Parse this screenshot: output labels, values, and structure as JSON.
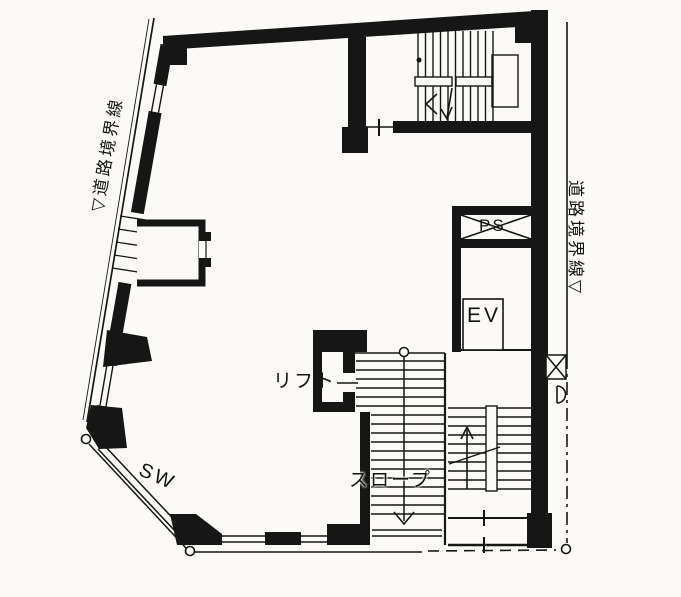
{
  "floor_plan": {
    "boundaries": {
      "left_label": "▽道路境界線",
      "right_label": "道路境界線▽"
    },
    "annotations": {
      "lift": "リフト",
      "slope": "スロープ",
      "pipe_space": "PS",
      "elevator": "EV",
      "show_window": "SW"
    },
    "colors": {
      "ink": "#161616",
      "paper": "#fbfaf7"
    }
  }
}
